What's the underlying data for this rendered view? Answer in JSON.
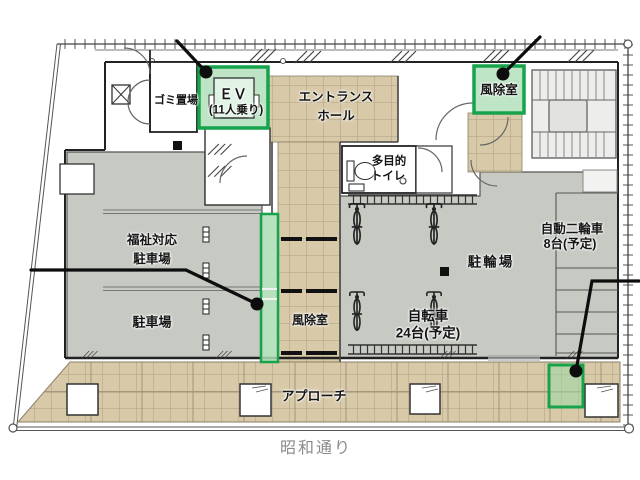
{
  "plan": {
    "labels": {
      "garbage": "ゴミ置場",
      "elevator_line1": "ＥＶ",
      "elevator_line2": "(11人乗り)",
      "entrance_line1": "エントランス",
      "entrance_line2": "ホール",
      "windbreak_top": "風除室",
      "toilet_line1": "多目的",
      "toilet_line2": "トイレ",
      "welfare_parking_line1": "福祉対応",
      "welfare_parking_line2": "駐車場",
      "parking": "駐車場",
      "windbreak_middle": "風除室",
      "motorcycle_line1": "自動二輪車",
      "motorcycle_line2": "8台(予定)",
      "bicycle_parking": "駐輪場",
      "bicycle_line1": "自転車",
      "bicycle_line2": "24台(予定)",
      "approach": "アプローチ",
      "street": "昭和通り"
    },
    "colors": {
      "tile_fill": "#d8caa9",
      "tile_line": "#ab9d7f",
      "area_gray": "#c6cac3",
      "highlight_green": "#17a34b",
      "highlight_green_fill": "#b7e2c0",
      "wall": "#222222",
      "street_text": "#8a8a8a"
    }
  }
}
